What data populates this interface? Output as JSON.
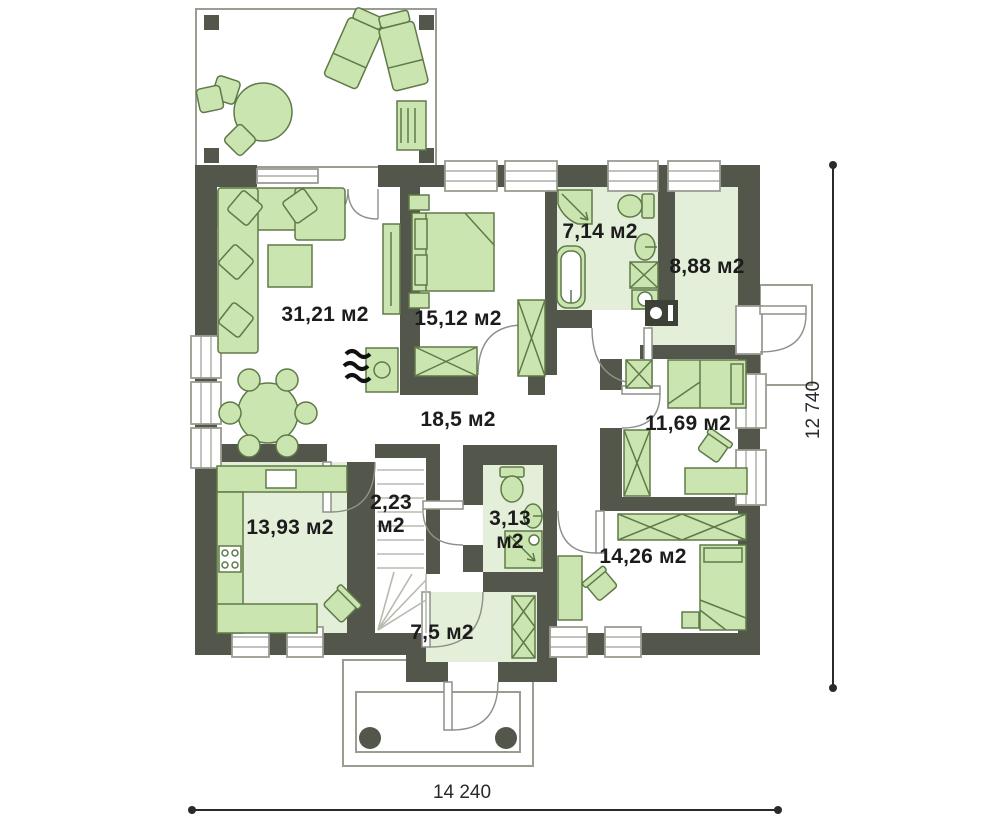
{
  "plan": {
    "rooms": {
      "living": {
        "area": "31,21 м2"
      },
      "bedroom1": {
        "area": "15,12 м2"
      },
      "bathroom": {
        "area": "7,14 м2"
      },
      "utility": {
        "area": "8,88 м2"
      },
      "hall": {
        "area": "18,5 м2"
      },
      "bedroom2": {
        "area": "11,69 м2"
      },
      "kitchen": {
        "area": "13,93 м2"
      },
      "pantry": {
        "area": "2,23 м2"
      },
      "wc": {
        "area": "3,13 м2"
      },
      "bedroom3": {
        "area": "14,26 м2"
      },
      "vestibule": {
        "area": "7,5 м2"
      }
    },
    "dimensions": {
      "width": "14 240",
      "height": "12 740"
    },
    "colors": {
      "wall": "#53564a",
      "furn": "#cbe5b0",
      "furnline": "#5f7a49",
      "tint": "#e4efda",
      "outline": "#9a9d92",
      "doorline": "#8d9089",
      "hatch": "#b7bbae",
      "dim": "#2a2a2a",
      "text": "#1c1c1c",
      "boiler": "#3e4136"
    }
  }
}
